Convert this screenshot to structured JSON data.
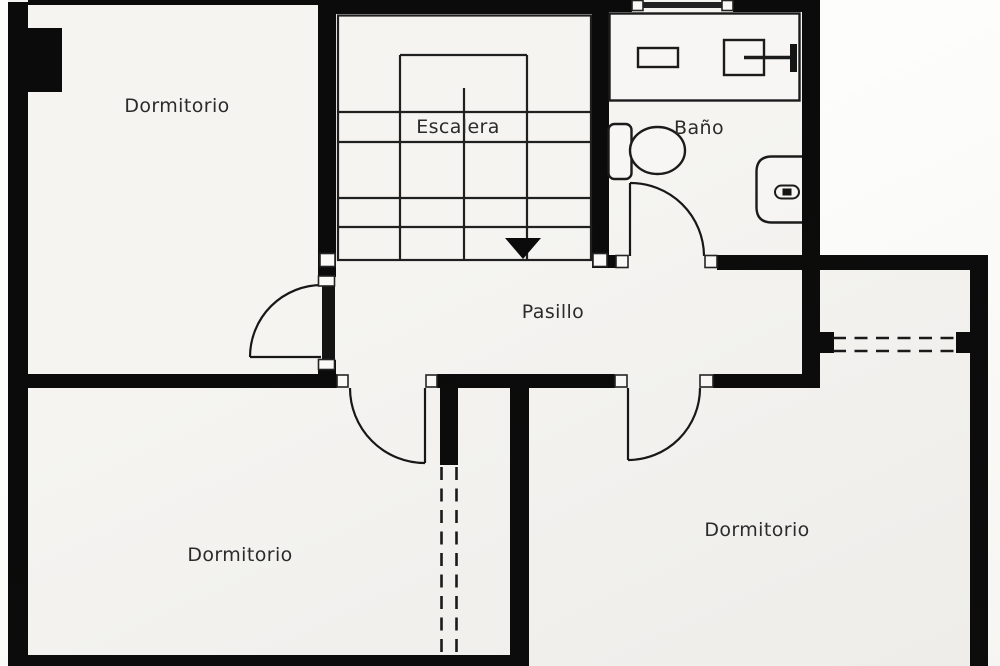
{
  "floor_plan": {
    "labels": {
      "bedroom_top_left": "Dormitorio",
      "staircase": "Escalera",
      "bathroom": "Baño",
      "hallway": "Pasillo",
      "bedroom_bottom_left": "Dormitorio",
      "bedroom_bottom_right": "Dormitorio"
    },
    "colors": {
      "wall": "#0b0b0b",
      "thin_line": "#1b1b1b",
      "floor": "#f5f4f1",
      "exterior": "#fdfdfb",
      "text": "#2b2b2b"
    }
  }
}
